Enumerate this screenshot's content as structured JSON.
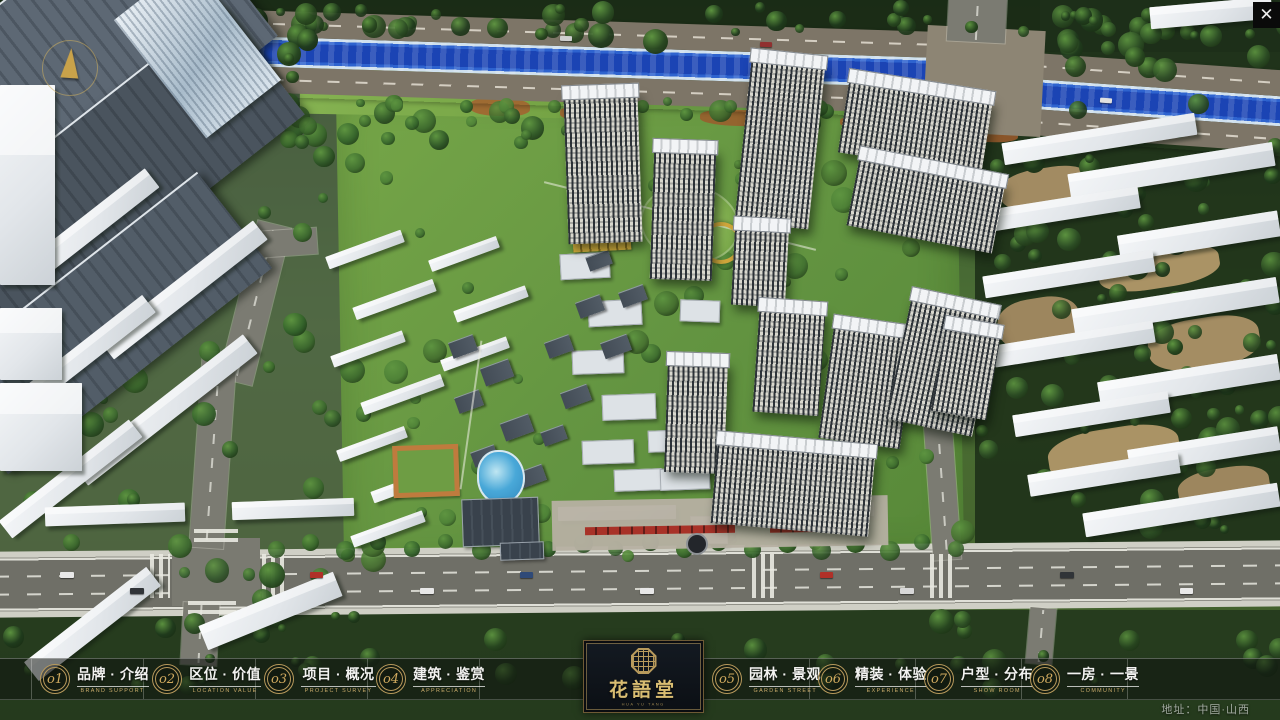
{
  "ui": {
    "close": {
      "icon_glyph": "✕"
    },
    "address": "地址：中国·山西",
    "logo": {
      "title": "花語堂",
      "subtitle": "HUA YU TANG"
    },
    "menu": [
      {
        "num": "o1",
        "label": "品牌 · 介绍",
        "en": "BRAND SUPPORT",
        "key": "brand-intro"
      },
      {
        "num": "o2",
        "label": "区位 · 价值",
        "en": "LOCATION VALUE",
        "key": "location-value"
      },
      {
        "num": "o3",
        "label": "项目 · 概况",
        "en": "PROJECT SURVEY",
        "key": "project-overview"
      },
      {
        "num": "o4",
        "label": "建筑 · 鉴赏",
        "en": "APPRECIATION",
        "key": "architecture-appreciation"
      },
      {
        "num": "o5",
        "label": "园林 · 景观",
        "en": "GARDEN STREET",
        "key": "garden-landscape"
      },
      {
        "num": "o6",
        "label": "精装 · 体验",
        "en": "EXPERIENCE",
        "key": "interior-experience"
      },
      {
        "num": "o7",
        "label": "户型 · 分布",
        "en": "SHOW ROOM",
        "key": "unit-distribution"
      },
      {
        "num": "o8",
        "label": "一房 · 一景",
        "en": "COMMUNITY",
        "key": "one-room-one-view"
      }
    ]
  }
}
